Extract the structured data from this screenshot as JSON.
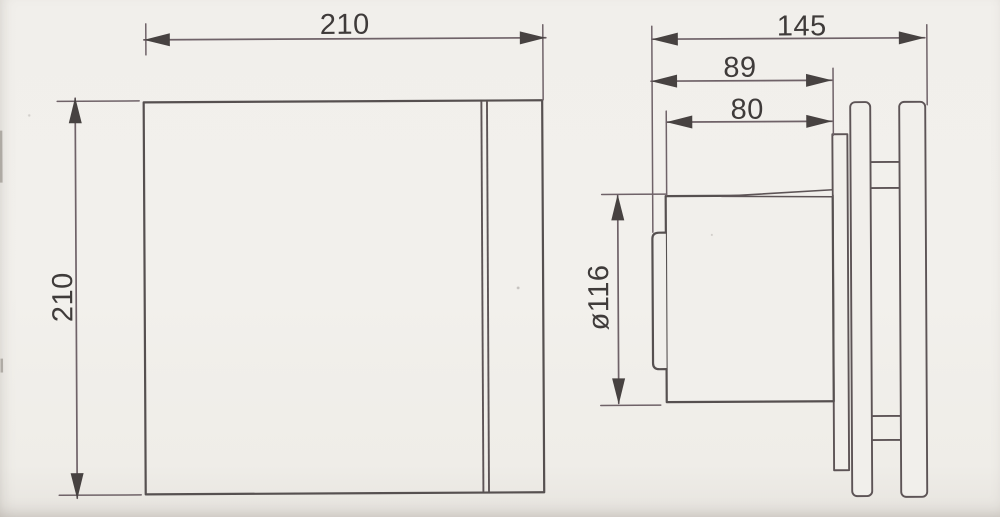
{
  "dimensions": {
    "front_width": "210",
    "front_height": "210",
    "side_total_depth": "145",
    "side_depth_to_backplate": "89",
    "side_body_depth": "80",
    "side_diameter": "ø116"
  },
  "colors": {
    "background": "#f1efeb",
    "outline": "#565050",
    "dimension_line": "#6f6268",
    "text": "#3f3b3a"
  }
}
